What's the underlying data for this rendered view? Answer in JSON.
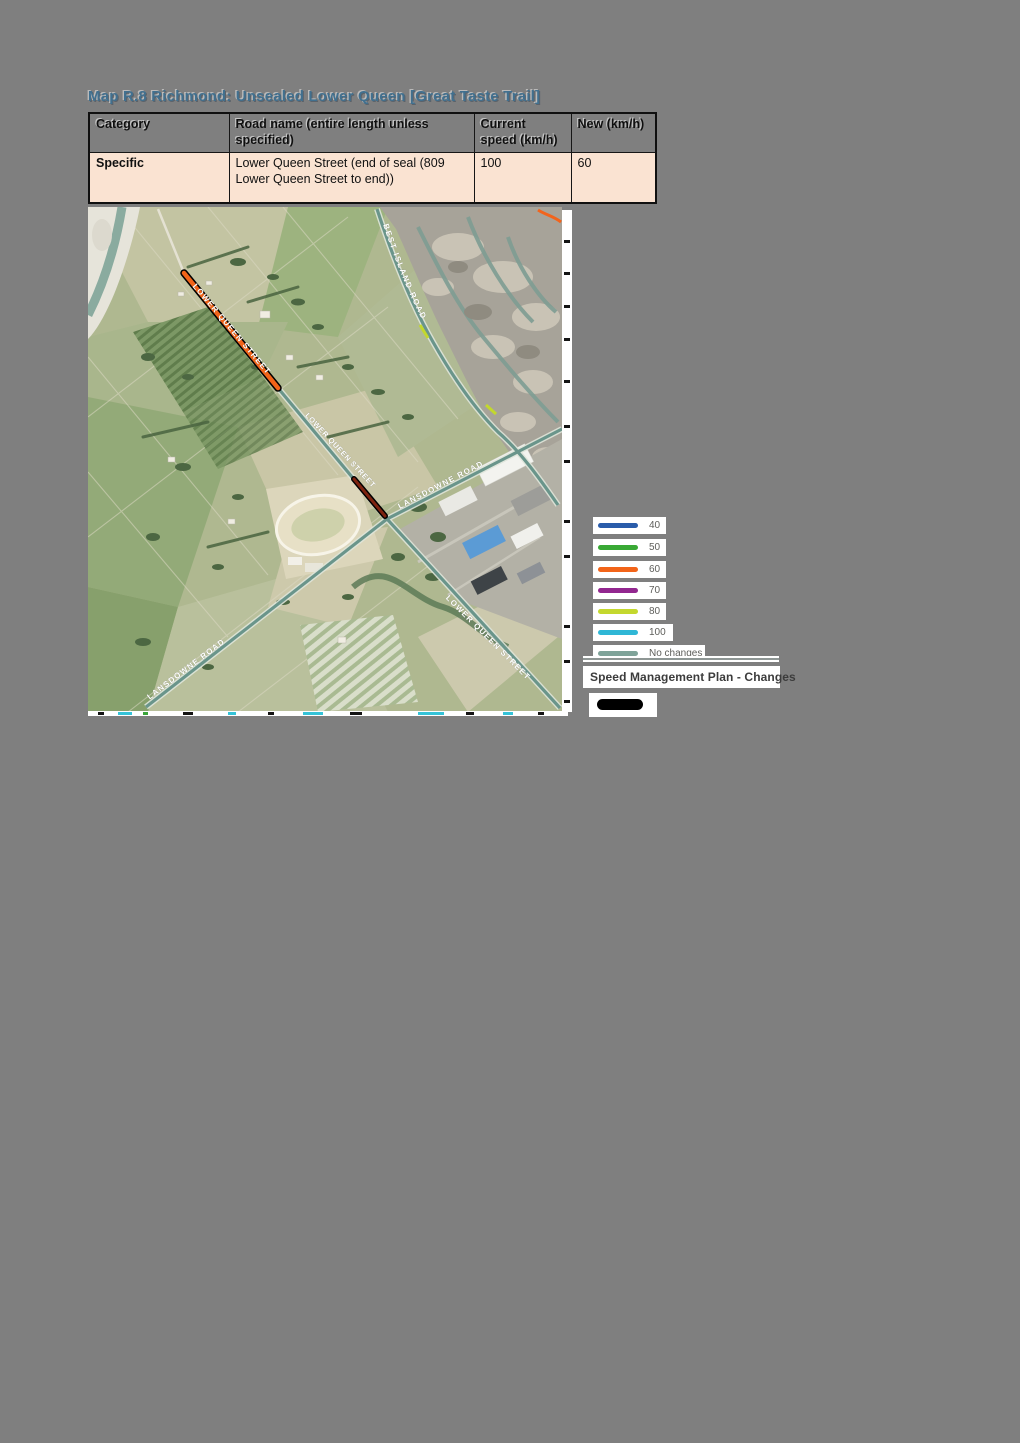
{
  "title": {
    "text": "Map R.8 Richmond: Unsealed Lower Queen [Great Taste Trail]"
  },
  "table": {
    "headers": [
      "Category",
      "Road name (entire length unless specified)",
      "Current speed (km/h)",
      "New (km/h)"
    ],
    "rows": [
      {
        "category": "Specific",
        "road_name": "Lower Queen Street (end of seal (809 Lower Queen Street to end))",
        "current_speed": "100",
        "new_speed": "60"
      }
    ]
  },
  "map": {
    "highlight_color": "#F26419",
    "highlight_casing": "#000000",
    "road_labels": {
      "best_island_road": "BEST ISLAND ROAD",
      "lower_queen_street_upper": "LOWER QUEEN STREET",
      "lower_queen_street_mid": "LOWER QUEEN STREET",
      "lansdowne_road_upper": "LANSDOWNE ROAD",
      "lansdowne_road_lower": "LANSDOWNE ROAD",
      "lower_queen_street_lower": "LOWER QUEEN STREET"
    }
  },
  "legend": {
    "items": [
      {
        "label": "40",
        "color": "#2A5CAA"
      },
      {
        "label": "50",
        "color": "#39A935"
      },
      {
        "label": "60",
        "color": "#F26419"
      },
      {
        "label": "70",
        "color": "#92278F"
      },
      {
        "label": "80",
        "color": "#C4D82E"
      },
      {
        "label": "100",
        "color": "#2FB7D6"
      },
      {
        "label": "No changes",
        "color": "#7FA399"
      }
    ],
    "title": "Speed Management Plan - Changes",
    "symbol_color": "#000000"
  }
}
